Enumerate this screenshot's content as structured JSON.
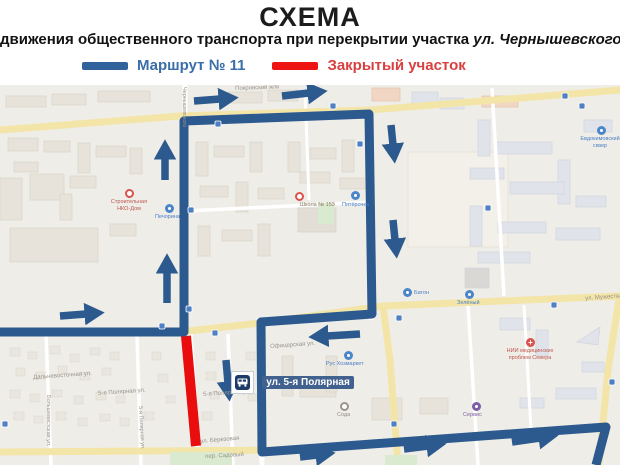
{
  "header": {
    "title": "СХЕМА",
    "subtitle_regular": "движения общественного транспорта при перекрытии участка ",
    "subtitle_italic": "ул. Чернышевского",
    "legend": {
      "route_label": "Маршрут № 11",
      "closed_label": "Закрытый участок"
    }
  },
  "colors": {
    "route_blue": "#2d5a8e",
    "closed_red": "#e90d0d",
    "legend_route_text": "#3a6ea8",
    "legend_closed_text": "#d94040",
    "bus_label_bg": "#41618f",
    "yellow_road": "#f3e5a8"
  },
  "map": {
    "bus_stop_label": "ул. 5-я Полярная",
    "street_labels": [
      {
        "text": "ул. Мужества"
      },
      {
        "text": "ул. Березовая"
      },
      {
        "text": "Дальневосточная ул."
      },
      {
        "text": "5-я Полярная ул."
      },
      {
        "text": "5-я Полярная ул."
      },
      {
        "text": "Офицерская ул."
      },
      {
        "text": "пер. Садовый"
      },
      {
        "text": "Чернышевского"
      },
      {
        "text": "Большевистская ул."
      },
      {
        "text": "5-я Полярная ул."
      },
      {
        "text": "Покровский ж/м"
      }
    ],
    "pois": {
      "school": {
        "label": "Школа № 153"
      },
      "stroika": {
        "line1": "Строительная",
        "line2": "НКО-Дом"
      },
      "pecherina": {
        "label": "Печорина"
      },
      "pyaterochka": {
        "label": "Пятёрочка"
      },
      "baton": {
        "label": "Батон"
      },
      "zeleny": {
        "label": "Зелёный"
      },
      "rusmarket": {
        "label": "Рус Хозмаркет"
      },
      "soda": {
        "label": "Сода"
      },
      "servis": {
        "label": "Сервис"
      },
      "skver": {
        "line1": "Евдокимовский",
        "line2": "сквер"
      },
      "nii": {
        "line1": "НИИ медицинских",
        "line2": "проблем Севера"
      }
    }
  }
}
